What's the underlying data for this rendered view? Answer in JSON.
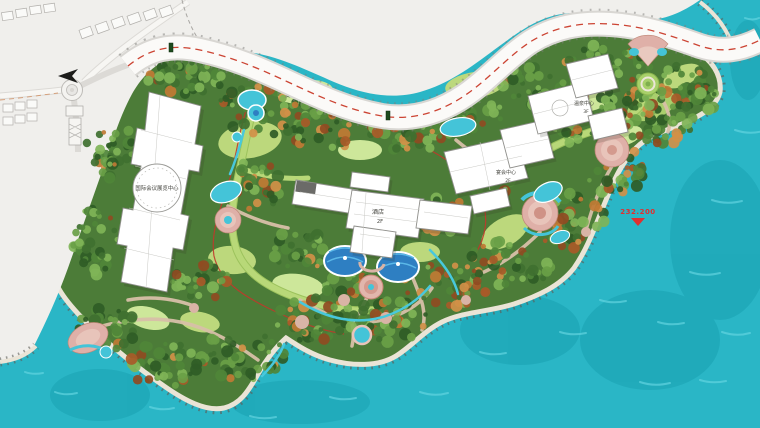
{
  "plan": {
    "type": "resort-landscape-masterplan",
    "labels": {
      "conference_center": "国际会议展览中心",
      "hotel_name": "酒店",
      "hotel_floors": "2F",
      "banquet_center": "宴会中心",
      "banquet_floors": "2F",
      "spa_center": "温泉中心",
      "spa_floors": "3F",
      "water_elevation": "232.200"
    },
    "icons": {
      "elevation_marker": "inverted-triangle",
      "direction_arrow": "left-arrow",
      "road_sign": "small-green-post"
    },
    "palette": {
      "water": "#2ab6c6",
      "water_wave": "#62d4e0",
      "water_deep": "#189fb0",
      "context_land": "#f0efec",
      "road_surface": "#fbfaf8",
      "road_casing": "#d9d7d3",
      "shore_sand": "#eae4d6",
      "shore_tick": "#5e5e58",
      "red_trail": "#c0392b",
      "site_green": "#4c7c38",
      "lawn_green": "#bcd87c",
      "tree_dark_green": "#2f5c26",
      "tree_autumn_orange": "#b06a2e",
      "path_tan": "#d8c0a8",
      "loop_road_green": "#b8d878",
      "plaza_pink": "#dfb0a8",
      "pool_teal": "#44c4d8",
      "fountain_blue": "#2e7fc2",
      "building_white": "#ffffff",
      "elevation_red": "#e03030"
    }
  }
}
